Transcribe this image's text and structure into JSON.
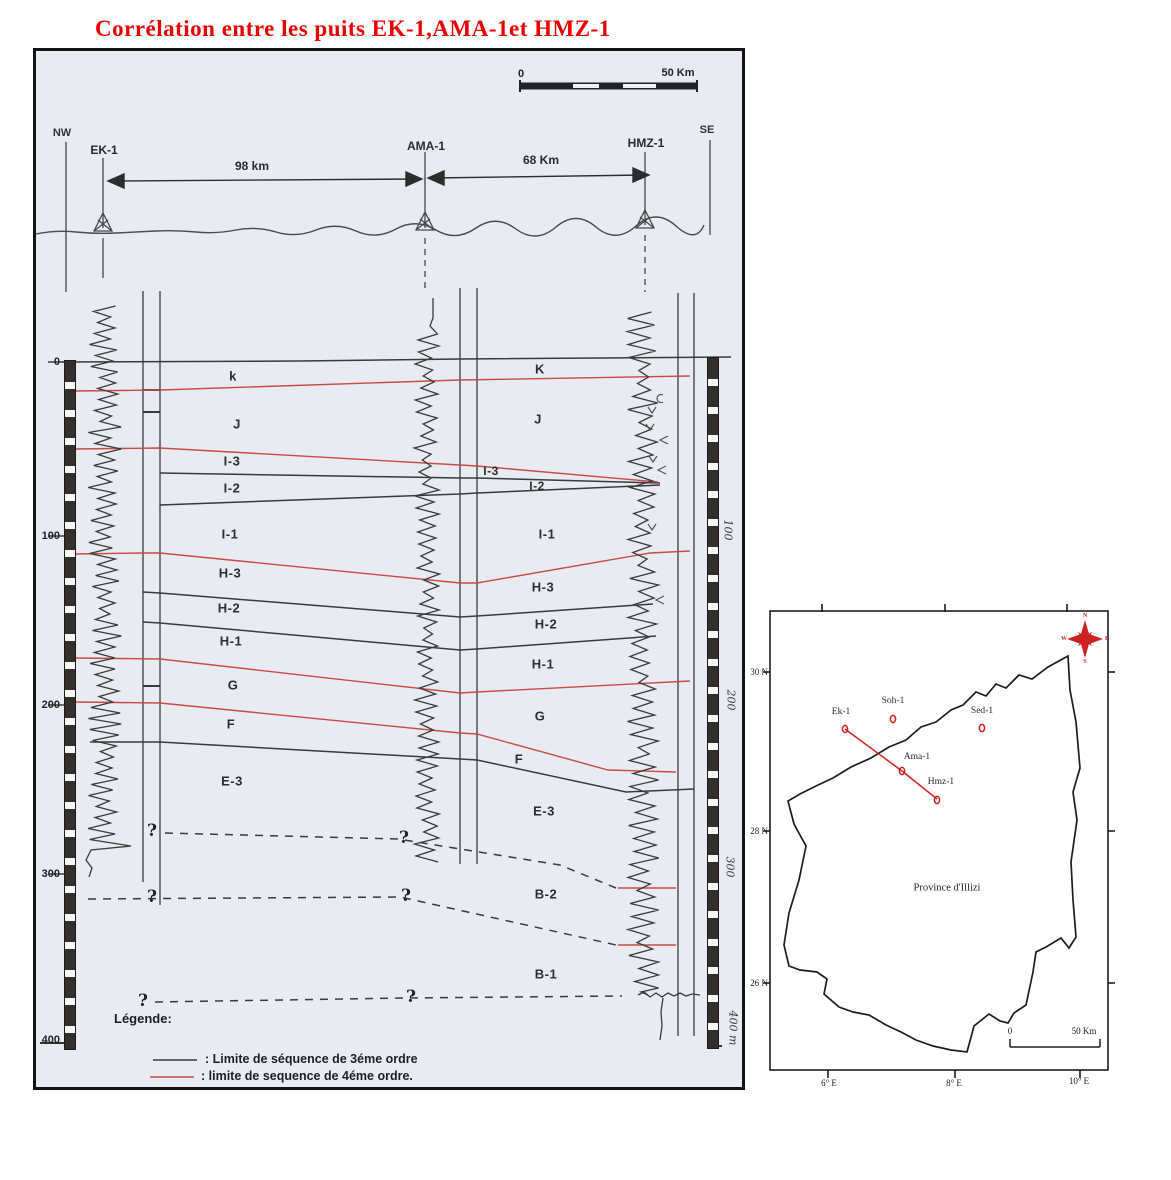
{
  "title": "Corrélation entre les puits EK-1,AMA-1et HMZ-1",
  "section": {
    "scalebar": {
      "zero": "0",
      "end": "50 Km"
    },
    "nw": "NW",
    "se": "SE",
    "wells": [
      "EK-1",
      "AMA-1",
      "HMZ-1"
    ],
    "distance_1": "98 km",
    "distance_2": "68 Km",
    "depth_ticks": [
      "0",
      "100",
      "200",
      "300",
      "400"
    ],
    "right_depths": [
      "100",
      "200",
      "300",
      "400 m"
    ],
    "zones_left": [
      "k",
      "J",
      "I-3",
      "I-2",
      "I-1",
      "H-3",
      "H-2",
      "H-1",
      "G",
      "F",
      "E-3"
    ],
    "zones_right": [
      "K",
      "J",
      "I-3",
      "I-2",
      "I-1",
      "H-3",
      "H-2",
      "H-1",
      "G",
      "F",
      "E-3",
      "B-2",
      "B-1"
    ],
    "qmark": "?",
    "legend_title": "Légende:",
    "legend_item_3rd": ": Limite de séquence de 3éme ordre",
    "legend_item_4th": ": limite de sequence de 4éme ordre."
  },
  "map": {
    "lats": [
      "30 N",
      "28 N",
      "26 N"
    ],
    "lons": [
      "6° E",
      "8° E",
      "10° E"
    ],
    "wells": [
      "Ek-1",
      "Soh-1",
      "Sed-1",
      "Ama-1",
      "Hmz-1"
    ],
    "region": "Province d'Illizi",
    "scalebar": {
      "zero": "0",
      "end": "50 Km"
    },
    "compass": {
      "n": "N",
      "s": "S",
      "e": "E",
      "w": "W"
    }
  },
  "colors": {
    "title_red": "#e80000",
    "boundary_red": "#c84b44",
    "boundary_black": "#3a3a3a",
    "map_red": "#cc2222"
  }
}
